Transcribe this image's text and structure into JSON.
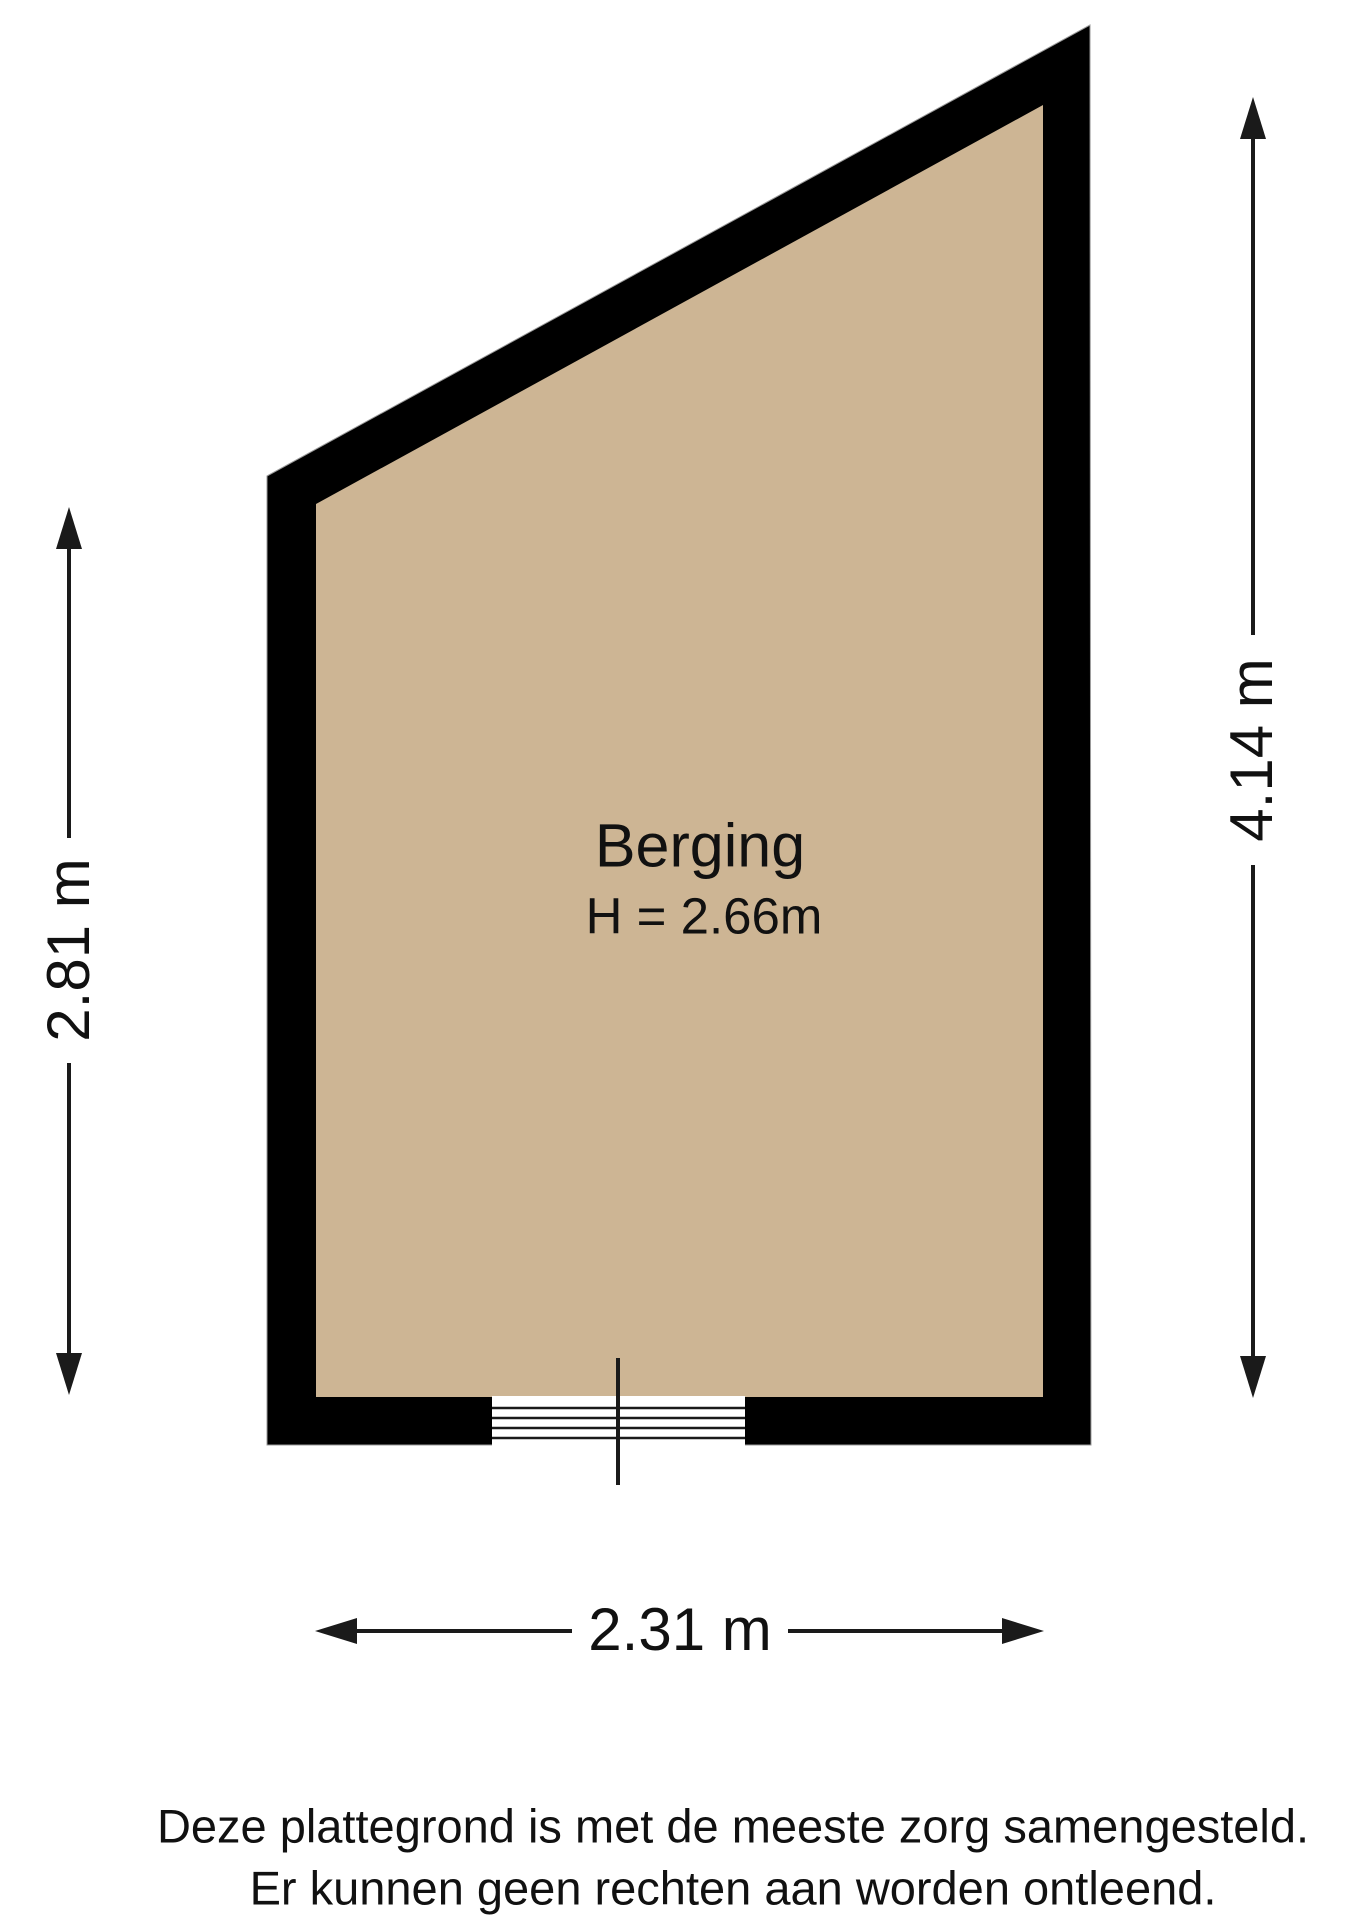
{
  "floorplan": {
    "title_room": {
      "name": "Berging",
      "height_label": "H = 2.66m"
    },
    "dimensions": {
      "left_vertical": "2.81 m",
      "right_vertical": "4.14 m",
      "bottom_horizontal": "2.31 m"
    },
    "disclaimer": {
      "line1": "Deze plattegrond is met de meeste zorg samengesteld.",
      "line2": "Er kunnen geen rechten aan worden ontleend."
    },
    "colors": {
      "wall": "#000000",
      "floor": "#CDB594",
      "line": "#1A1A1A",
      "background": "#FFFFFF"
    }
  }
}
